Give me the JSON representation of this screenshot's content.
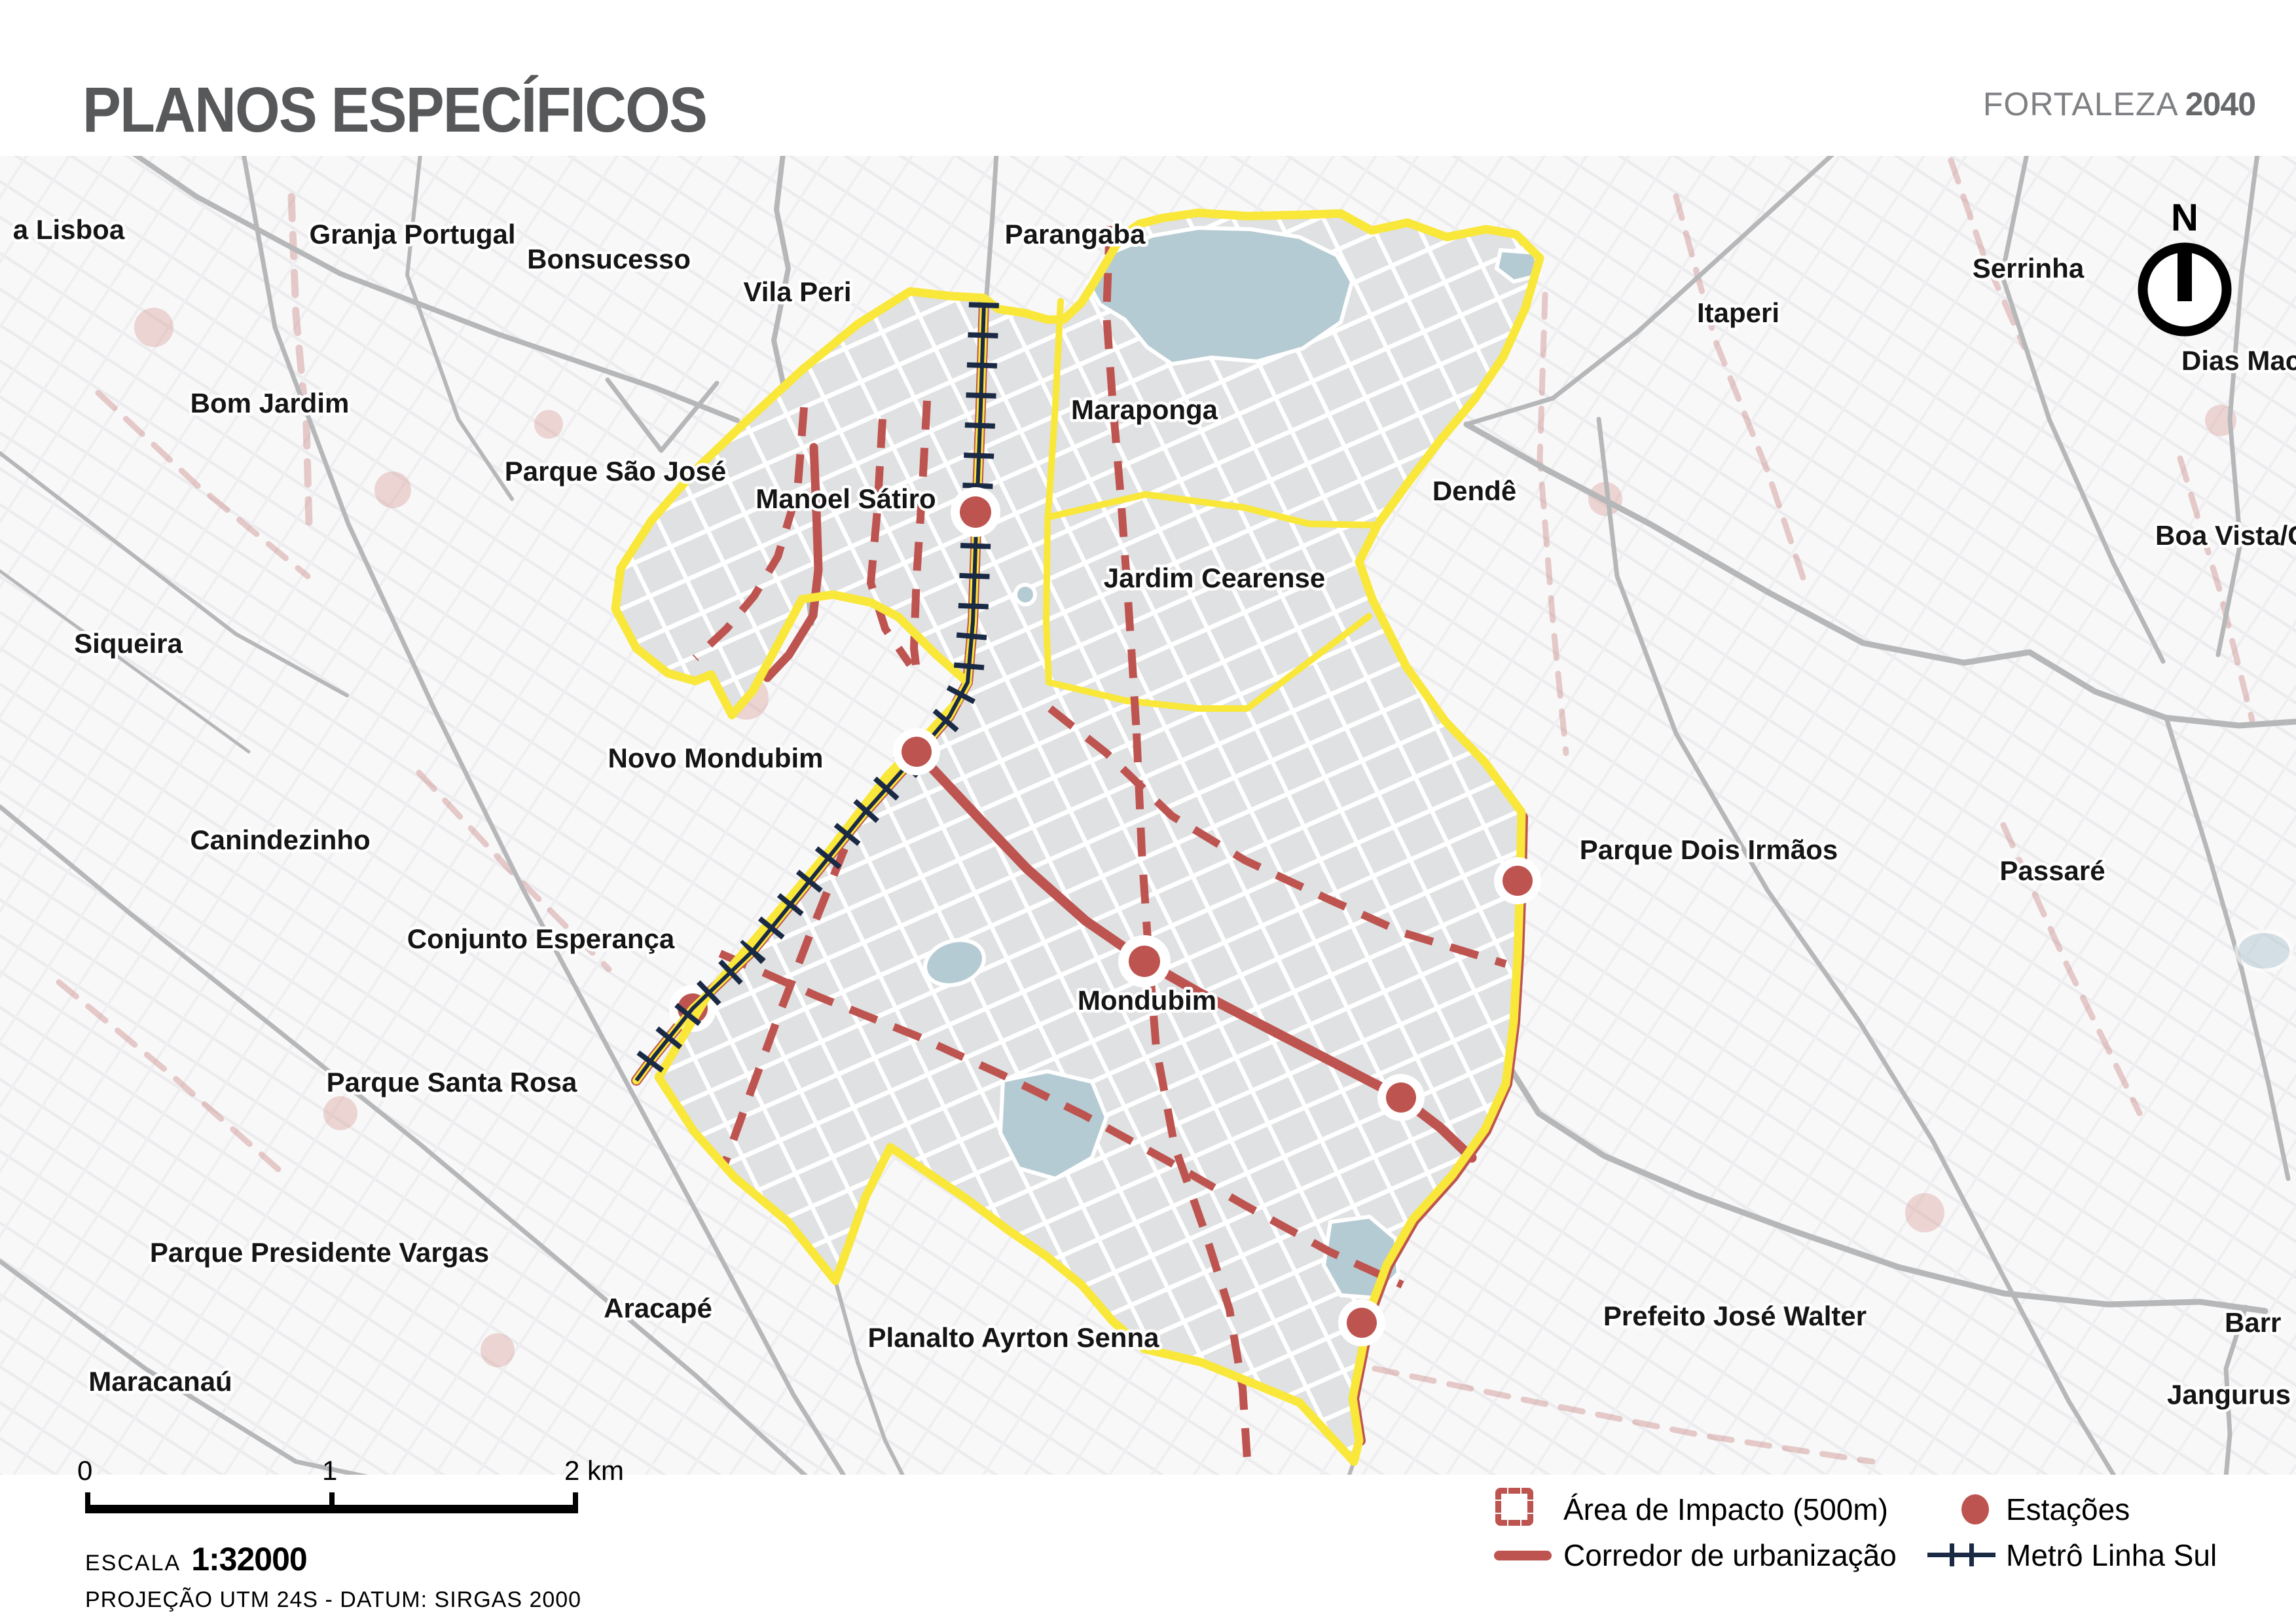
{
  "header": {
    "title": "PLANOS ESPECÍFICOS",
    "brand_name": "FORTALEZA",
    "brand_year": "2040"
  },
  "map": {
    "north_label": "N",
    "labels": [
      {
        "id": "granja-lisboa",
        "text": "a Lisboa"
      },
      {
        "id": "granja-portugal",
        "text": "Granja Portugal"
      },
      {
        "id": "bonsucesso",
        "text": "Bonsucesso"
      },
      {
        "id": "vila-peri",
        "text": "Vila Peri"
      },
      {
        "id": "parangaba",
        "text": "Parangaba"
      },
      {
        "id": "serrinha",
        "text": "Serrinha"
      },
      {
        "id": "itaperi",
        "text": "Itaperi"
      },
      {
        "id": "dias-macedo",
        "text": "Dias Macê"
      },
      {
        "id": "bom-jardim",
        "text": "Bom Jardim"
      },
      {
        "id": "maraponga",
        "text": "Maraponga"
      },
      {
        "id": "parque-sao-jose",
        "text": "Parque São José"
      },
      {
        "id": "manoel-satiro",
        "text": "Manoel Sátiro"
      },
      {
        "id": "dende",
        "text": "Dendê"
      },
      {
        "id": "boa-vista",
        "text": "Boa Vista/Ca"
      },
      {
        "id": "jardim-cearense",
        "text": "Jardim Cearense"
      },
      {
        "id": "siqueira",
        "text": "Siqueira"
      },
      {
        "id": "novo-mondubim",
        "text": "Novo Mondubim"
      },
      {
        "id": "canindezinho",
        "text": "Canindezinho"
      },
      {
        "id": "parque-dois-irmaos",
        "text": "Parque Dois Irmãos"
      },
      {
        "id": "passare",
        "text": "Passaré"
      },
      {
        "id": "conjunto-esperanca",
        "text": "Conjunto Esperança"
      },
      {
        "id": "mondubim",
        "text": "Mondubim"
      },
      {
        "id": "parque-santa-rosa",
        "text": "Parque Santa Rosa"
      },
      {
        "id": "parque-presidente-vargas",
        "text": "Parque Presidente Vargas"
      },
      {
        "id": "aracape",
        "text": "Aracapé"
      },
      {
        "id": "planalto-ayrton-senna",
        "text": "Planalto Ayrton Senna"
      },
      {
        "id": "prefeito-jose-walter",
        "text": "Prefeito José Walter"
      },
      {
        "id": "maracanau",
        "text": "Maracanaú"
      },
      {
        "id": "barroso",
        "text": "Barr"
      },
      {
        "id": "jangurussu",
        "text": "Jangurus"
      }
    ],
    "colors": {
      "plan_boundary_yellow": "#F9E73A",
      "corridor_red": "#BE5450",
      "metro_navy": "#1B2A44",
      "station_red": "#BE5450",
      "lake_blue": "#B5CBD3",
      "road_gray": "#B6B7B9"
    }
  },
  "legend": {
    "items": [
      {
        "id": "impact-area",
        "label": "Área de Impacto (500m)"
      },
      {
        "id": "stations",
        "label": "Estações"
      },
      {
        "id": "corridor",
        "label": "Corredor de urbanização"
      },
      {
        "id": "metro-line",
        "label": "Metrô Linha Sul"
      }
    ]
  },
  "scale": {
    "tick_0": "0",
    "tick_1": "1",
    "tick_2": "2 km",
    "escala_label": "ESCALA",
    "escala_value": "1:32000",
    "projection": "PROJEÇÃO UTM 24S - DATUM: SIRGAS 2000"
  }
}
